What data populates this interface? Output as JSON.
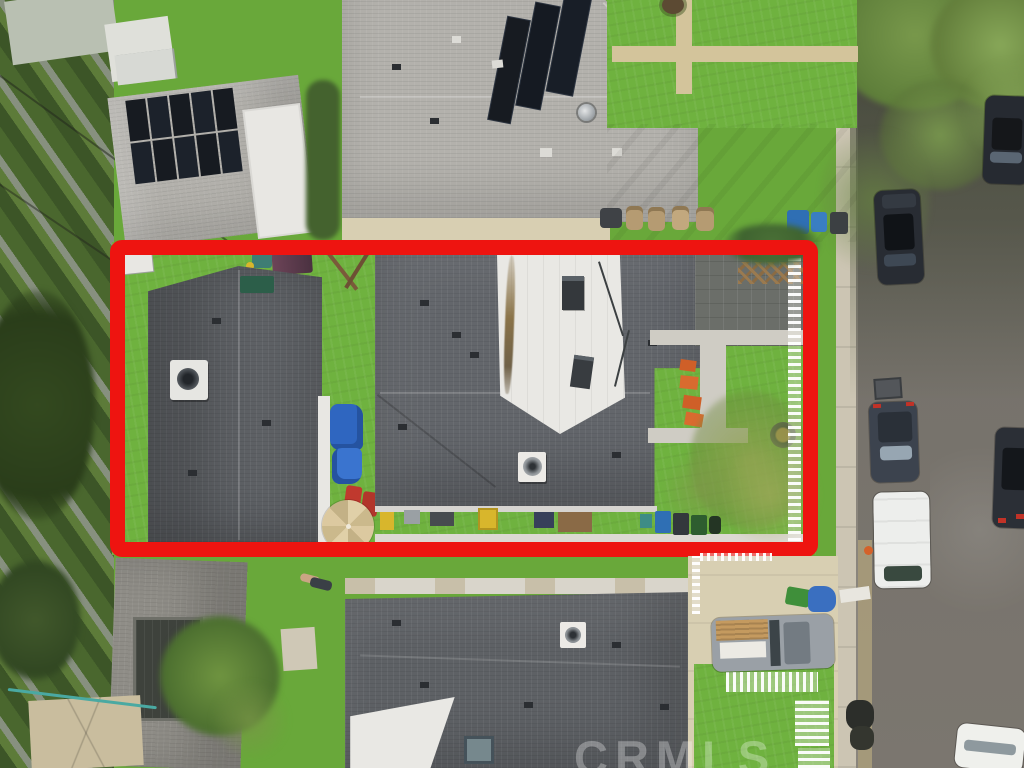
{
  "scene": {
    "description": "Overhead aerial drone photo of a residential neighborhood; the subject lot with two dark-roofed buildings is outlined by a thick red rectangle; street with parked cars on the right; CRMLS watermark at bottom",
    "watermark": "CRMLS"
  },
  "annotation": {
    "label": "subject-property-outline",
    "shape": "rectangle",
    "stroke_px": 15
  },
  "colors": {
    "grass": "#69a83a",
    "grassBright": "#6fb23f",
    "roofLight": "#b3b1ac",
    "roofLighter": "#c0beb9",
    "roofDark": "#63666b",
    "roofDarker": "#55585c",
    "roofBottom": "#5e6165",
    "solar": "#171b21",
    "whiteRoof": "#e9e8e4",
    "red": "#ee1410",
    "street": "#76726b",
    "sidewalk": "#ccc5b3",
    "concrete": "#d8cfb2",
    "vegDark": "#3c5527",
    "vegMid": "#5d7b39",
    "canopy": "#6d8b44",
    "tarp": "#2f66c0",
    "umbrella": "#d6c49a",
    "carDark": "#262a31",
    "carBlue": "#3c434e",
    "vanWhite": "#edeeec",
    "truckGray": "#9aa0a6",
    "lumber": "#c49a5f",
    "orangeChair": "#cf5f28",
    "binBlue": "#2f6fb4",
    "fenceWhite": "#f2f1ec",
    "hedge": "#3f6330",
    "shedTan": "#c9bd9e",
    "wallWhite": "#e8e7e3",
    "stainBrown": "#8a7348"
  },
  "objects": {
    "outlined_lot": "red rectangle around subject property with rear house, main house, backyard",
    "left_rear_house": "dark gray shingle roof with AC unit",
    "main_house": "dark gray shingle roof with white flat roof section, HVAC units, attic fan",
    "top_left_house": "light gray roof with 10-panel solar array",
    "top_middle_house": "large light gray roof with three slanted solar strips and turbine vent",
    "bottom_house": "dark gray roof with white wedge and skylight",
    "street": "vertical street at right with tree canopy shadow",
    "vehicles": "two dark cars upper street, dark car and white van mid street, dark car right edge, white car bottom corner, gray pickup with lumber in driveway",
    "yard_items": "tan patio umbrella, blue tarp, red lounge chairs, orange chairs, fire pit, trash bins, white picket fences, playset"
  }
}
